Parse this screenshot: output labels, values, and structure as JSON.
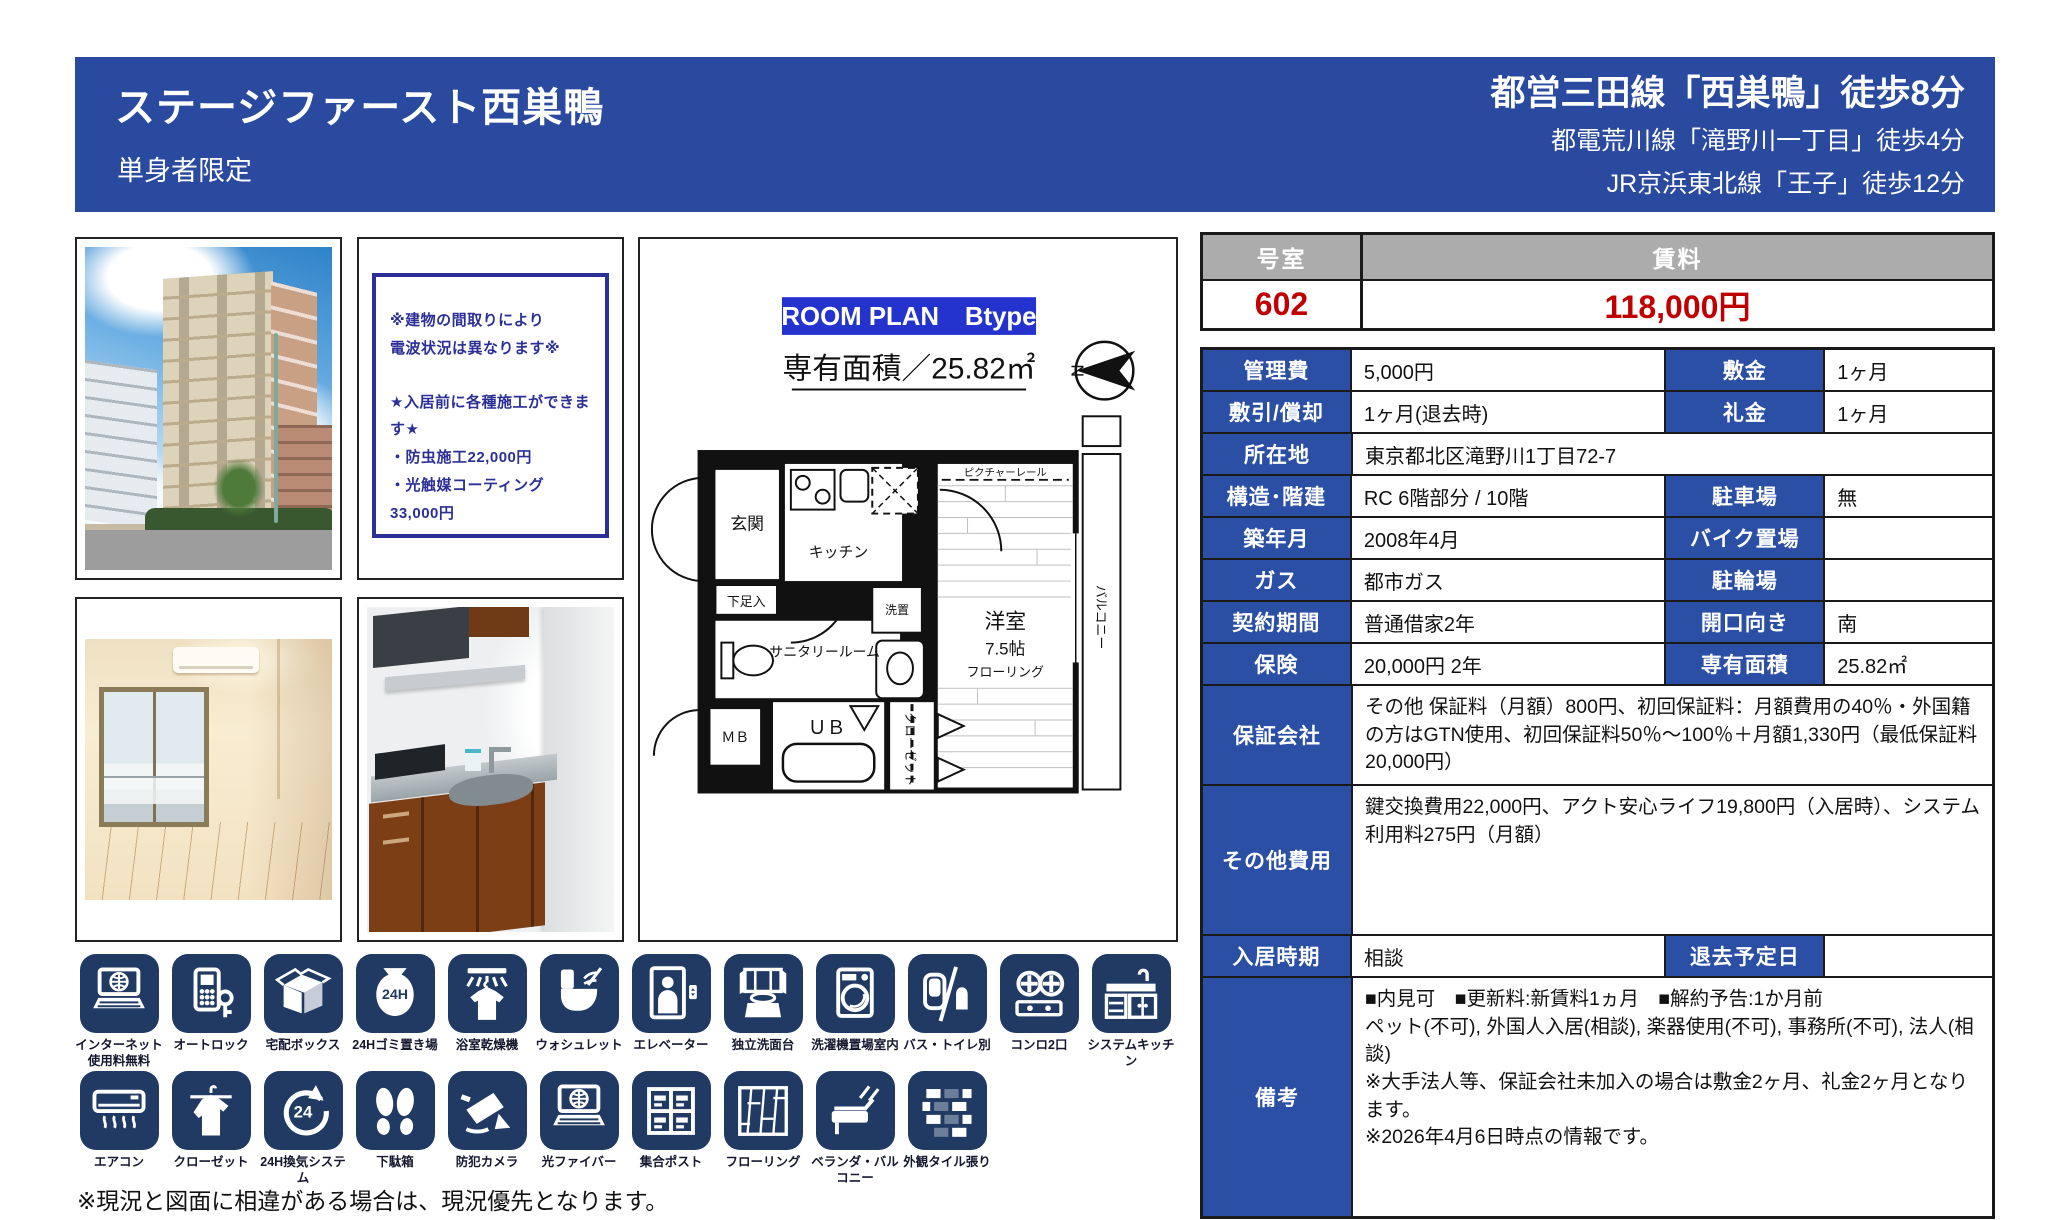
{
  "colors": {
    "primary_blue": "#2A4A9F",
    "cell_blue": "#2B4FA5",
    "plan_blue": "#2433CE",
    "note_navy": "#2B2F96",
    "icon_navy": "#203A64",
    "price_red": "#C00000",
    "header_gray": "#ACACAC"
  },
  "header": {
    "title": "ステージファースト西巣鴨",
    "subtitle": "単身者限定",
    "access_lines": [
      "都営三田線「西巣鴨」徒歩8分",
      "都電荒川線「滝野川一丁目」徒歩4分",
      "JR京浜東北線「王子」徒歩12分"
    ]
  },
  "note_box": {
    "lines": [
      "※建物の間取りにより",
      "電波状況は異なります※",
      "",
      "★入居前に各種施工ができます★",
      "・防虫施工22,000円",
      "・光触媒コーティング33,000円"
    ]
  },
  "floor_plan": {
    "plan_label": "ROOM PLAN　Btype",
    "area_label": "専有面積／25.82㎡",
    "compass_letter": "N",
    "room_labels": {
      "entrance": "玄関",
      "kitchen": "キッチン",
      "shoe_cabinet": "下足入",
      "washer": "洗置",
      "sanitary": "サニタリールーム",
      "unit_bath": "ＵＢ",
      "meter_box": "ＭＢ",
      "closet": "クローゼット",
      "western_room": "洋室",
      "western_room_size": "7.5帖",
      "western_room_floor": "フローリング",
      "balcony": "バルコニー",
      "picture_rail": "ピクチャーレール"
    }
  },
  "price_table": {
    "room_header": "号室",
    "rent_header": "賃料",
    "room_no": "602",
    "rent": "118,000円"
  },
  "detail_table": {
    "rows": [
      {
        "label": "管理費",
        "value": "5,000円",
        "label2": "敷金",
        "value2": "1ヶ月"
      },
      {
        "label": "敷引/償却",
        "value": "1ヶ月(退去時)",
        "label2": "礼金",
        "value2": "1ヶ月"
      },
      {
        "label": "所在地",
        "value": "東京都北区滝野川1丁目72-7",
        "span": true
      },
      {
        "label": "構造･階建",
        "value": "RC 6階部分 / 10階",
        "label2": "駐車場",
        "value2": "無"
      },
      {
        "label": "築年月",
        "value": "2008年4月",
        "label2": "バイク置場",
        "value2": ""
      },
      {
        "label": "ガス",
        "value": "都市ガス",
        "label2": "駐輪場",
        "value2": ""
      },
      {
        "label": "契約期間",
        "value": "普通借家2年",
        "label2": "開口向き",
        "value2": "南"
      },
      {
        "label": "保険",
        "value": "20,000円 2年",
        "label2": "専有面積",
        "value2": "25.82㎡"
      },
      {
        "label": "保証会社",
        "value": "その他 保証料（月額）800円、初回保証料：月額費用の40％・外国籍の方はGTN使用、初回保証料50％～100％＋月額1,330円（最低保証料20,000円）",
        "span": true
      },
      {
        "label": "その他費用",
        "value": "鍵交換費用22,000円、アクト安心ライフ19,800円（入居時）、システム利用料275円（月額）",
        "span": true
      },
      {
        "label": "入居時期",
        "value": "相談",
        "label2": "退去予定日",
        "value2": ""
      },
      {
        "label": "備考",
        "value": "■内見可　■更新料:新賃料1ヵ月　■解約予告:1か月前\nペット(不可), 外国人入居(相談), 楽器使用(不可), 事務所(不可), 法人(相談)\n※大手法人等、保証会社未加入の場合は敷金2ヶ月、礼金2ヶ月となります。\n※2026年4月6日時点の情報です。",
        "span": true
      }
    ]
  },
  "amenities": {
    "badge_24h": "24H",
    "badge_24": "24",
    "row1": [
      {
        "icon": "internet-laptop-icon",
        "label": "インターネット\n使用料無料"
      },
      {
        "icon": "autolock-icon",
        "label": "オートロック"
      },
      {
        "icon": "delivery-box-icon",
        "label": "宅配ボックス"
      },
      {
        "icon": "trash-24h-icon",
        "label": "24Hゴミ置き場"
      },
      {
        "icon": "bathroom-dryer-icon",
        "label": "浴室乾燥機"
      },
      {
        "icon": "washlet-icon",
        "label": "ウォシュレット"
      },
      {
        "icon": "elevator-icon",
        "label": "エレベーター"
      },
      {
        "icon": "vanity-icon",
        "label": "独立洗面台"
      },
      {
        "icon": "washer-indoor-icon",
        "label": "洗濯機置場室内"
      },
      {
        "icon": "bath-toilet-separate-icon",
        "label": "バス・トイレ別"
      },
      {
        "icon": "stove-2-burner-icon",
        "label": "コンロ2口"
      },
      {
        "icon": "system-kitchen-icon",
        "label": "システムキッチン"
      }
    ],
    "row2": [
      {
        "icon": "aircon-icon",
        "label": "エアコン"
      },
      {
        "icon": "closet-icon",
        "label": "クローゼット"
      },
      {
        "icon": "ventilation-24h-icon",
        "label": "24H換気システム"
      },
      {
        "icon": "shoe-box-icon",
        "label": "下駄箱"
      },
      {
        "icon": "security-camera-icon",
        "label": "防犯カメラ"
      },
      {
        "icon": "optical-fiber-icon",
        "label": "光ファイバー"
      },
      {
        "icon": "mailbox-icon",
        "label": "集合ポスト"
      },
      {
        "icon": "flooring-icon",
        "label": "フローリング"
      },
      {
        "icon": "veranda-icon",
        "label": "ベランダ・バルコニー"
      },
      {
        "icon": "tile-exterior-icon",
        "label": "外観タイル張り"
      }
    ]
  },
  "page": {
    "footnote": "※現況と図面に相違がある場合は、現況優先となります。"
  }
}
